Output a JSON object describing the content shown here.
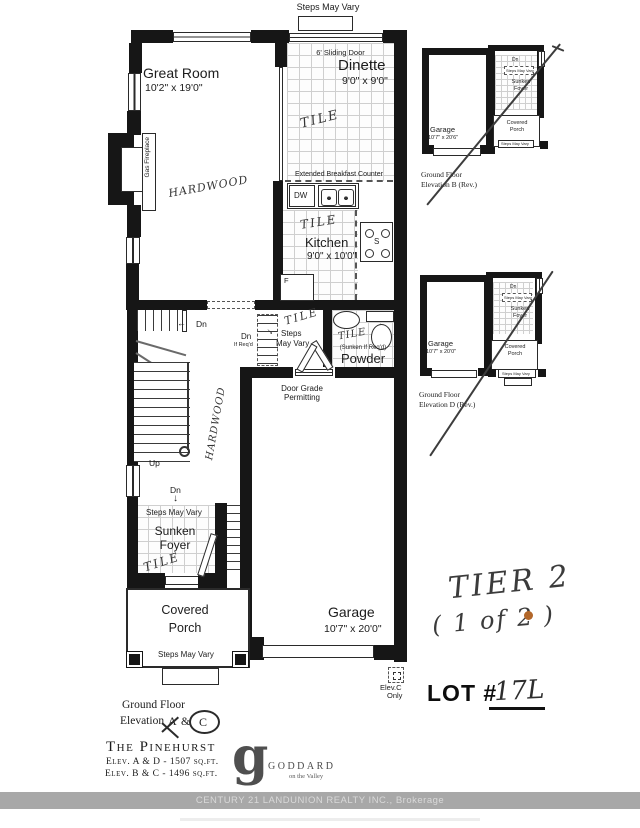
{
  "colors": {
    "wall": "#161616",
    "tile_line": "#cfcfcf",
    "handwriting": "#343434",
    "bar_bg": "#a8a8a8",
    "bar_text": "#d9d9d9",
    "annotation_dot": "#b2672a"
  },
  "plan": {
    "top_steps": "Steps May Vary",
    "sliding_door": "6' Sliding Door",
    "great_room": {
      "name": "Great Room",
      "dims": "10'2\" x 19'0\"",
      "floor": "HARDWOOD"
    },
    "dinette": {
      "name": "Dinette",
      "dims": "9'0\" x 9'0\"",
      "floor": "TILE"
    },
    "fireplace": "Gas Fireplace",
    "kitchen": {
      "counter": "Extended Breakfast Counter",
      "dw": "DW",
      "name": "Kitchen",
      "dims": "9'0\" x 10'0\"",
      "floor": "TILE",
      "stove": "S",
      "fridge": "F"
    },
    "stair": {
      "dn": "Dn",
      "up": "Up",
      "arrow_left": "←",
      "arrow_down": "↓"
    },
    "mid": {
      "dn": "Dn",
      "if_reqd": "If Req'd",
      "steps_line1": "Steps",
      "steps_line2": "May Vary",
      "tile": "TILE",
      "hall_floor": "HARDWOOD"
    },
    "powder": {
      "tile": "TILE",
      "sunken": "(Sunken If Req'd)",
      "name": "Powder"
    },
    "door_grade_line1": "Door Grade",
    "door_grade_line2": "Permitting",
    "foyer": {
      "dn": "Dn",
      "steps": "Steps May Vary",
      "name_line1": "Sunken",
      "name_line2": "Foyer",
      "tile": "TILE"
    },
    "porch": {
      "name_line1": "Covered",
      "name_line2": "Porch",
      "steps": "Steps May Vary"
    },
    "garage": {
      "name": "Garage",
      "dims": "10'7\" x 20'0\""
    },
    "elev_c": {
      "line1": "Elev.C",
      "line2": "Only"
    }
  },
  "insets": [
    {
      "garage": "Garage",
      "garage_dims": "10'7\" x 20'6\"",
      "dn": "Dn",
      "steps_top": "Steps May Vary",
      "foyer_line1": "Sunken",
      "foyer_line2": "Foyer",
      "porch_line1": "Covered",
      "porch_line2": "Porch",
      "steps_bottom": "Steps May Vary",
      "caption_line1": "Ground Floor",
      "caption_line2": "Elevation B (Rev.)"
    },
    {
      "garage": "Garage",
      "garage_dims": "10'7\" x 20'0\"",
      "dn": "Dn",
      "steps_top": "Steps May Vary",
      "foyer_line1": "Sunken",
      "foyer_line2": "Foyer",
      "porch_line1": "Covered",
      "porch_line2": "Porch",
      "steps_bottom": "Steps May Vary",
      "caption_line1": "Ground Floor",
      "caption_line2": "Elevation D (Rev.)"
    }
  ],
  "annotations": {
    "tier_line1": "TIER 2",
    "tier_line2": "( 1 of 2 )",
    "lot_label": "LOT #",
    "lot_value": "17L"
  },
  "footer": {
    "caption_line1": "Ground Floor",
    "caption_pre": "Elevation",
    "caption_a": "A",
    "caption_amp": "&",
    "caption_c": "C",
    "model": "The Pinehurst",
    "sqft_a": "Elev. A & D - 1507 sq.ft.",
    "sqft_b": "Elev. B & C - 1496 sq.ft.",
    "logo_g": "g",
    "logo_name": "GODDARD",
    "logo_tag": "on the Valley",
    "brokerage": "CENTURY 21 LANDUNION REALTY INC., Brokerage"
  }
}
